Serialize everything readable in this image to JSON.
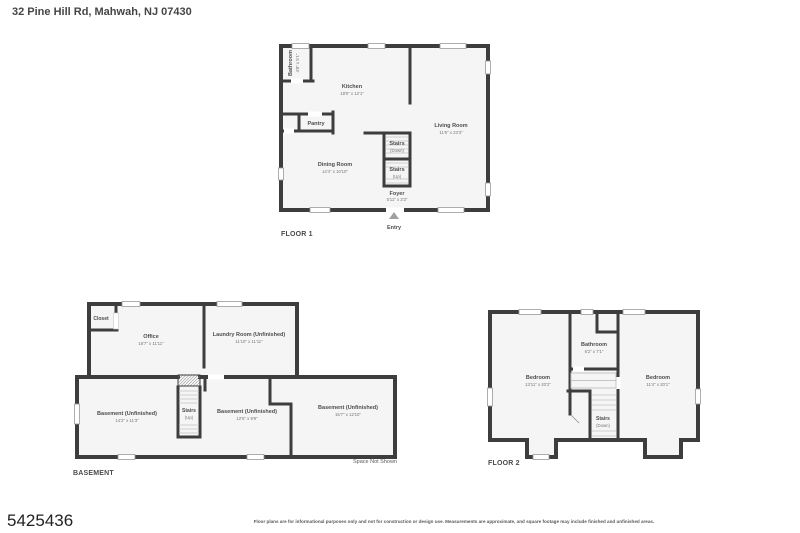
{
  "header": {
    "title": "32 Pine Hill Rd, Mahwah, NJ 07430"
  },
  "floor1": {
    "label": "FLOOR 1",
    "entry": "Entry",
    "rooms": {
      "bathroom": {
        "name": "Bathroom",
        "dims": "4'8\" x 5'1\""
      },
      "kitchen": {
        "name": "Kitchen",
        "dims": "18'0\" x 12'1\""
      },
      "pantry": {
        "name": "Pantry"
      },
      "living": {
        "name": "Living Room",
        "dims": "11'6\" x 23'3\""
      },
      "dining": {
        "name": "Dining Room",
        "dims": "14'4\" x 10'10\""
      },
      "stairs_down": {
        "name": "Stairs",
        "dims": "(Down)"
      },
      "stairs_up": {
        "name": "Stairs",
        "dims": "(Up)"
      },
      "foyer": {
        "name": "Foyer",
        "dims": "5'11\" x 3'3\""
      }
    }
  },
  "basement": {
    "label": "BASEMENT",
    "space_not_shown": "Space Not Shown",
    "rooms": {
      "closet": {
        "name": "Closet"
      },
      "office": {
        "name": "Office",
        "dims": "16'7\" x 11'11\""
      },
      "laundry": {
        "name": "Laundry Room (Unfinished)",
        "dims": "11'10\" x 11'11\""
      },
      "bsmt_left": {
        "name": "Basement (Unfinished)",
        "dims": "14'2\" x 11'3\""
      },
      "bsmt_mid": {
        "name": "Basement (Unfinished)",
        "dims": "12'5\" x 9'9\""
      },
      "bsmt_right": {
        "name": "Basement (Unfinished)",
        "dims": "15'7\" x 12'10\""
      },
      "stairs_up": {
        "name": "Stairs",
        "dims": "(Up)"
      }
    }
  },
  "floor2": {
    "label": "FLOOR 2",
    "rooms": {
      "bedroom_left": {
        "name": "Bedroom",
        "dims": "13'11\" x 20'2\""
      },
      "bedroom_right": {
        "name": "Bedroom",
        "dims": "11'4\" x 20'1\""
      },
      "bathroom": {
        "name": "Bathroom",
        "dims": "6'2\" x 7'1\""
      },
      "stairs_down": {
        "name": "Stairs",
        "dims": "(Down)"
      }
    }
  },
  "footer": {
    "listing_id": "5425436",
    "disclaimer": "Floor plans are for informational purposes only and not for construction or design use. Measurements are approximate, and square footage may include finished and unfinished areas."
  }
}
